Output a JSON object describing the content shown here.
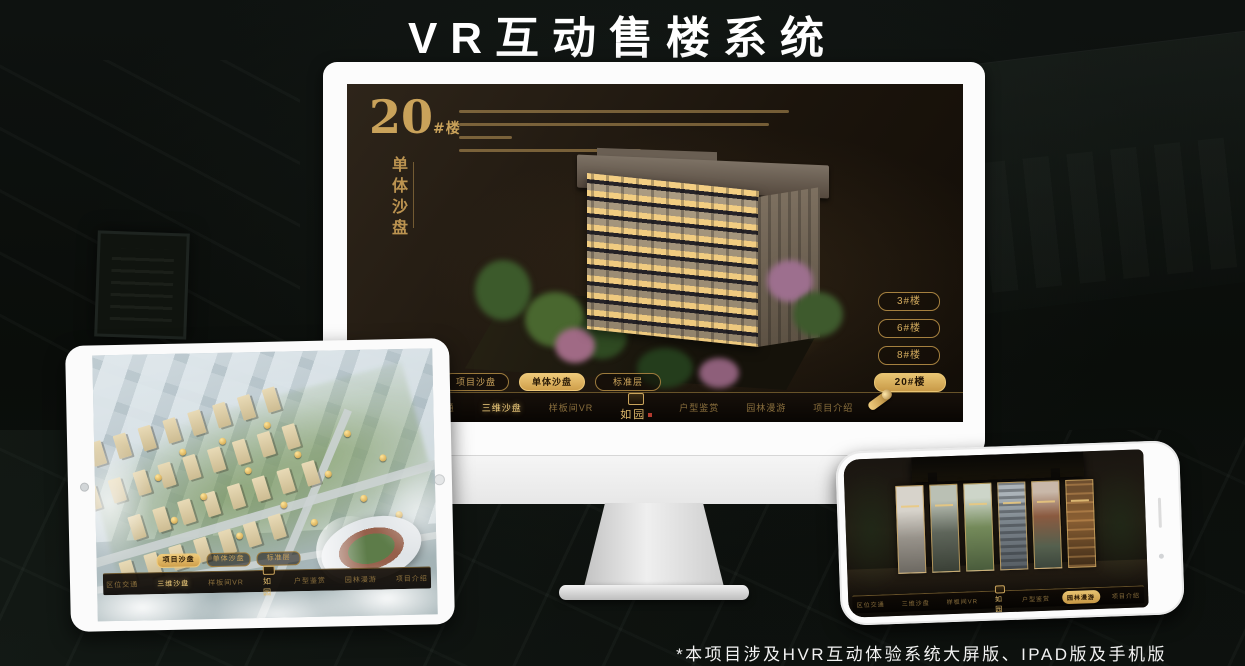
{
  "page": {
    "title": "VR互动售楼系统",
    "footnote": "*本项目涉及HVR互动体验系统大屏版、IPAD版及手机版"
  },
  "brand": {
    "logo": "如园",
    "gold": "#c9a35f"
  },
  "nav_items": [
    "区位交通",
    "三维沙盘",
    "样板间VR",
    "户型鉴赏",
    "园林漫游",
    "项目介绍"
  ],
  "desktop_screen": {
    "block_number": "20",
    "block_unit": "#楼",
    "block_subtitle": "单体沙盘",
    "floor_buttons": [
      {
        "label": "3#楼"
      },
      {
        "label": "6#楼"
      },
      {
        "label": "8#楼"
      },
      {
        "label": "20#楼"
      }
    ],
    "sub_tabs": [
      {
        "label": "项目沙盘"
      },
      {
        "label": "单体沙盘"
      },
      {
        "label": "标准层"
      }
    ],
    "active_nav": "三维沙盘",
    "active_floor": "20#楼",
    "active_sub_tab": "单体沙盘"
  },
  "tablet_screen": {
    "sub_tabs": [
      {
        "label": "项目沙盘"
      },
      {
        "label": "单体沙盘"
      },
      {
        "label": "标准层"
      }
    ],
    "active_nav": "三维沙盘",
    "active_sub_tab": "项目沙盘"
  },
  "phone_screen": {
    "active_nav": "园林漫游"
  }
}
